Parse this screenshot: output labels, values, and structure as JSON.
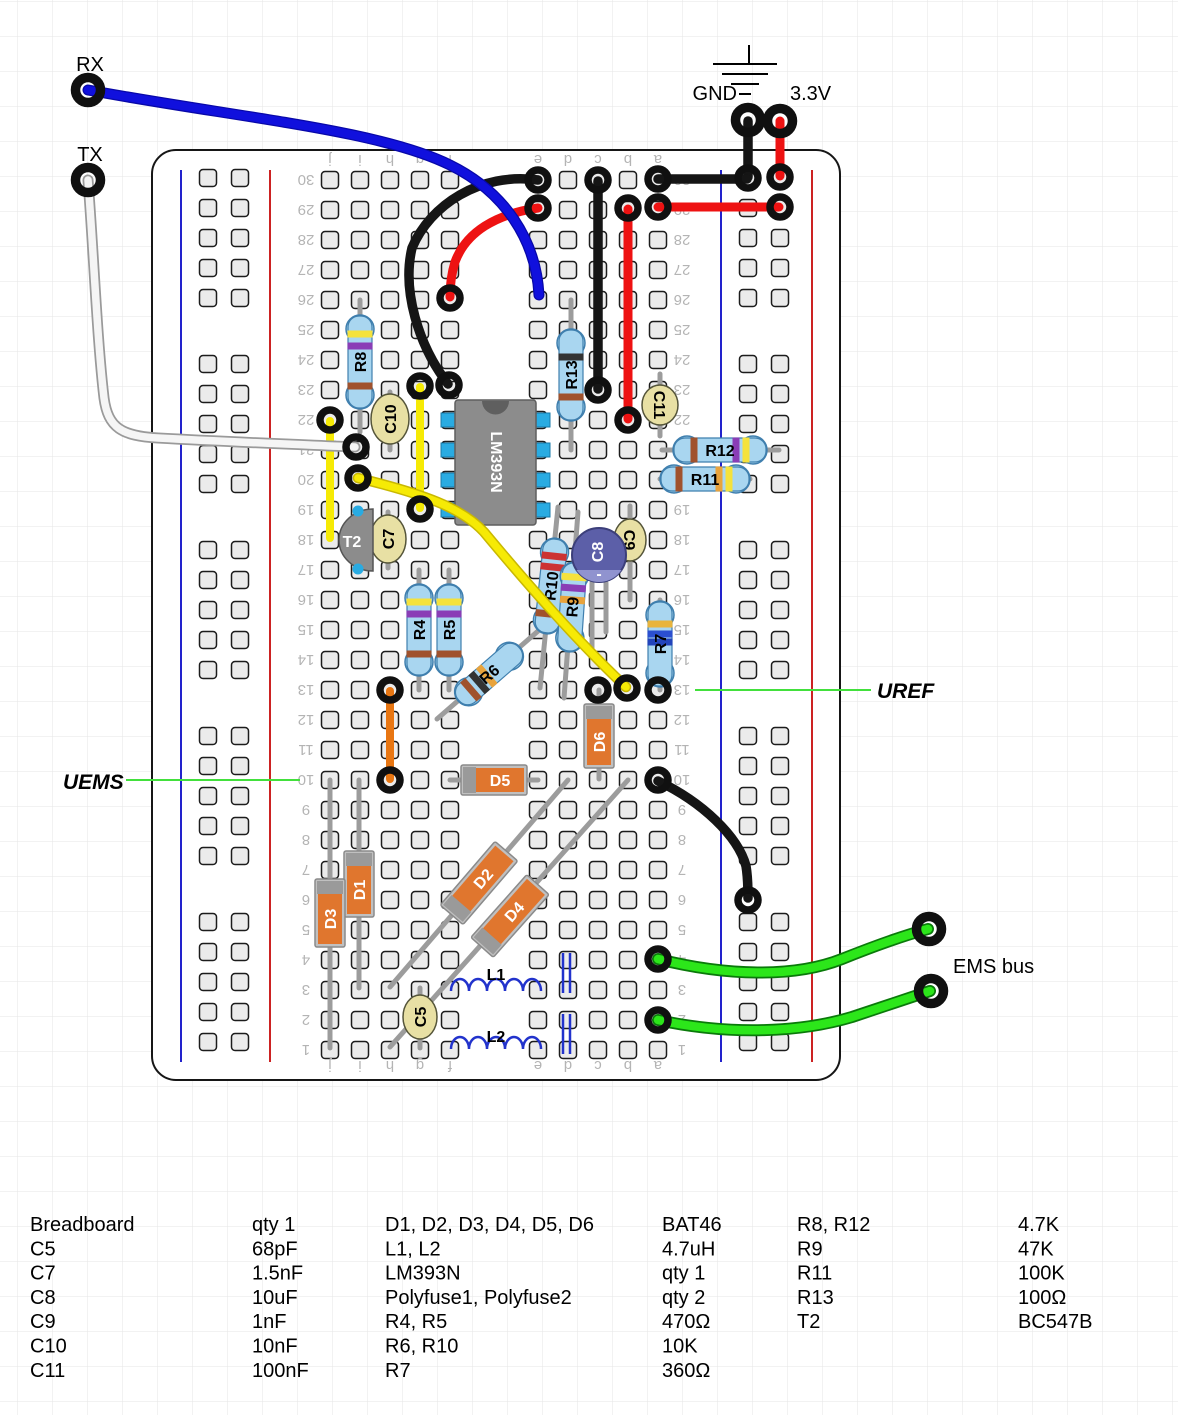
{
  "labels": {
    "rx": "RX",
    "tx": "TX",
    "gnd": "GND",
    "v33": "3.3V",
    "uref": "UREF",
    "uems": "UEMS",
    "ems_bus": "EMS bus"
  },
  "board": {
    "rows": 30,
    "letters_left": [
      "j",
      "i",
      "h",
      "g",
      "f"
    ],
    "letters_right": [
      "e",
      "d",
      "c",
      "b",
      "a"
    ]
  },
  "components": {
    "R4": "R4",
    "R5": "R5",
    "R6": "R6",
    "R7": "R7",
    "R8": "R8",
    "R9": "R9",
    "R10": "R10",
    "R11": "R11",
    "R12": "R12",
    "R13": "R13",
    "C5": "C5",
    "C7": "C7",
    "C8": "C8",
    "C9": "C9",
    "C10": "C10",
    "C11": "C11",
    "D1": "D1",
    "D2": "D2",
    "D3": "D3",
    "D4": "D4",
    "D5": "D5",
    "D6": "D6",
    "L1": "L1",
    "L2": "L2",
    "IC": "LM393N",
    "T2": "T2",
    "C8_polarity": "-"
  },
  "colors": {
    "wire_blue": "#1010dd",
    "wire_red": "#ee1212",
    "wire_black": "#151515",
    "wire_white": "#f5f5f5",
    "wire_yellow": "#f6ea05",
    "wire_green": "#2ce61a",
    "wire_orange": "#e87612",
    "callout_green": "#42e03c",
    "resistor_body": "#a9d6f0",
    "diode_body": "#e0762e",
    "capacitor_ceramic": "#e8e0a4",
    "capacitor_electrolytic": "#5c5fa8",
    "ic_body": "#8c8c8c",
    "ic_pin": "#29abe2",
    "rail_blue": "#2222cc",
    "rail_red": "#cc2222"
  },
  "parts_list": [
    [
      "Breadboard",
      "qty 1",
      "D1, D2, D3, D4, D5, D6",
      "BAT46",
      "R8, R12",
      "4.7K"
    ],
    [
      "C5",
      "68pF",
      "L1, L2",
      "4.7uH",
      "R9",
      "47K"
    ],
    [
      "C7",
      "1.5nF",
      "LM393N",
      "qty 1",
      "R11",
      "100K"
    ],
    [
      "C8",
      "10uF",
      "Polyfuse1, Polyfuse2",
      "qty 2",
      "R13",
      "100Ω"
    ],
    [
      "C9",
      "1nF",
      "R4, R5",
      "470Ω",
      "T2",
      "BC547B"
    ],
    [
      "C10",
      "10nF",
      "R6, R10",
      "10K",
      "",
      ""
    ],
    [
      "C11",
      "100nF",
      "R7",
      "360Ω",
      "",
      ""
    ]
  ]
}
